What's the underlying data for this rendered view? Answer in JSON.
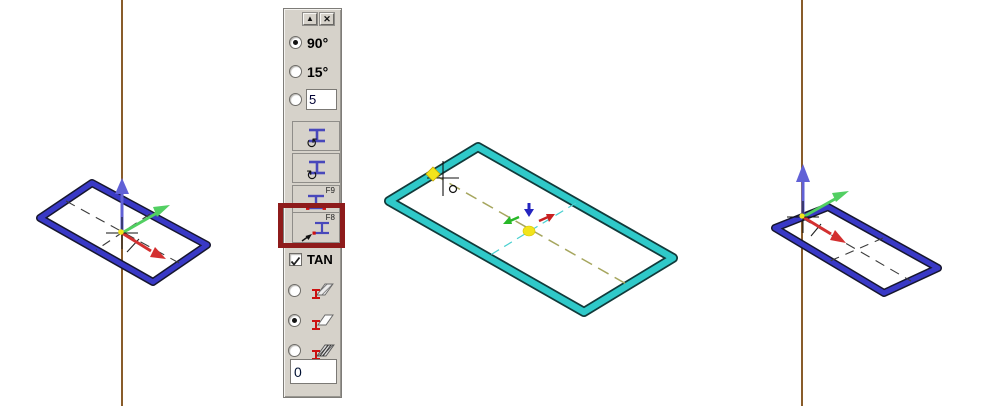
{
  "colors": {
    "construction_line": "#7c4a12",
    "sketch_blue": "#3939c6",
    "sketch_cyan": "#2fc9c9",
    "sketch_outline": "#16162e",
    "cyan_outline": "#113a3a",
    "centerline_dark": "#3c3c3c",
    "centerline_olive": "#a6a65e",
    "centerline_cyan": "#4ad0d0",
    "axis_red": "#d33030",
    "axis_green": "#52cf62",
    "axis_blue": "#6161d6",
    "mini_axis_blue": "#2525c0",
    "mini_axis_green": "#28b828",
    "mini_axis_red": "#c82020",
    "marker_yellow": "#f2e41c",
    "highlight_red": "#8e1b1b",
    "icon_beam_blue": "#4848bb",
    "icon_beam_red": "#cc1111"
  },
  "palette": {
    "rollup_glyph": "▲",
    "close_glyph": "✕",
    "angle_90": {
      "label": "90°",
      "selected": true
    },
    "angle_15": {
      "label": "15°",
      "selected": false
    },
    "angle_custom": {
      "value": "5",
      "selected": false
    },
    "rotate_ccw_glyph": "↺",
    "rotate_cw_glyph": "↻",
    "f9_label": "F9",
    "f8_label": "F8",
    "f8_highlighted": true,
    "tan": {
      "label": "TAN",
      "checked": true
    },
    "placement_options": [
      {
        "name": "extrude-hatched",
        "selected": false
      },
      {
        "name": "extrude-outline",
        "selected": true
      },
      {
        "name": "extrude-multi",
        "selected": false
      }
    ],
    "offset_value": "0"
  }
}
